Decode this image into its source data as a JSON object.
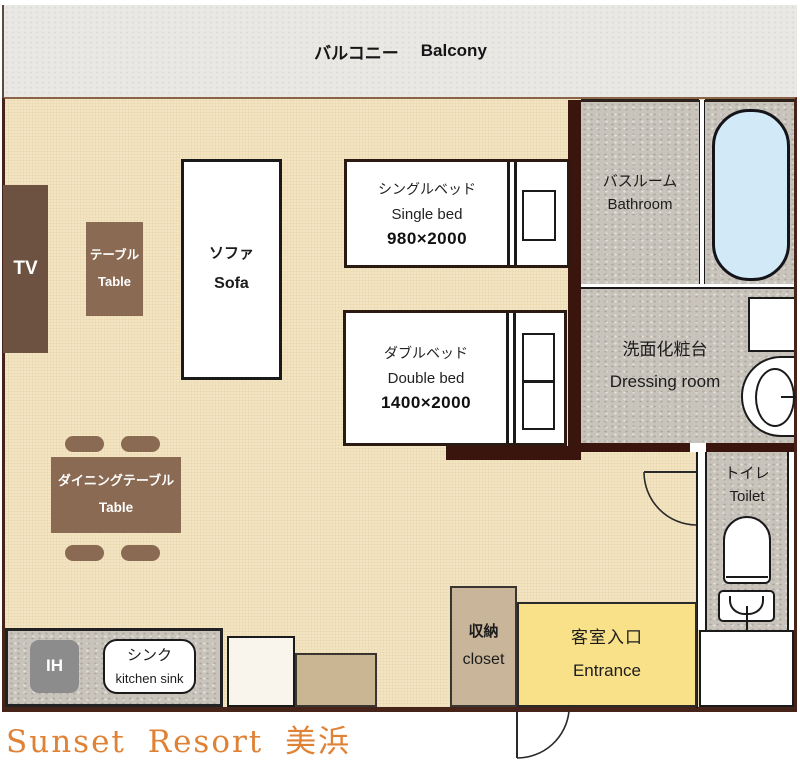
{
  "title": "Sunset Resort 美浜",
  "balcony": {
    "ja": "バルコニー",
    "en": "Balcony"
  },
  "rooms": {
    "bathroom": {
      "ja": "バスルーム",
      "en": "Bathroom"
    },
    "dressing": {
      "ja": "洗面化粧台",
      "en": "Dressing room"
    },
    "toilet": {
      "ja": "トイレ",
      "en": "Toilet"
    },
    "closet": {
      "ja": "収納",
      "en": "closet"
    },
    "entrance": {
      "ja": "客室入口",
      "en": "Entrance"
    }
  },
  "furniture": {
    "tv": {
      "label": "TV"
    },
    "table": {
      "ja": "テーブル",
      "en": "Table"
    },
    "sofa": {
      "ja": "ソファ",
      "en": "Sofa"
    },
    "single_bed": {
      "ja": "シングルベッド",
      "en": "Single bed",
      "size": "980×2000"
    },
    "double_bed": {
      "ja": "ダブルベッド",
      "en": "Double bed",
      "size": "1400×2000"
    },
    "dining_table": {
      "ja": "ダイニングテーブル",
      "en": "Table"
    },
    "kitchen": {
      "ih": "IH",
      "sink_ja": "シンク",
      "sink_en": "kitchen sink"
    }
  },
  "colors": {
    "floor_cream": "#f3e5c2",
    "room_gray": "#c8c3bb",
    "wall_dark": "#3a150d",
    "entrance_yellow": "#f8e189",
    "tub_blue": "#d2eaf8",
    "furniture_brown": "#8a6a52",
    "closet_tan": "#c9b59a",
    "title_orange": "#e08236"
  }
}
